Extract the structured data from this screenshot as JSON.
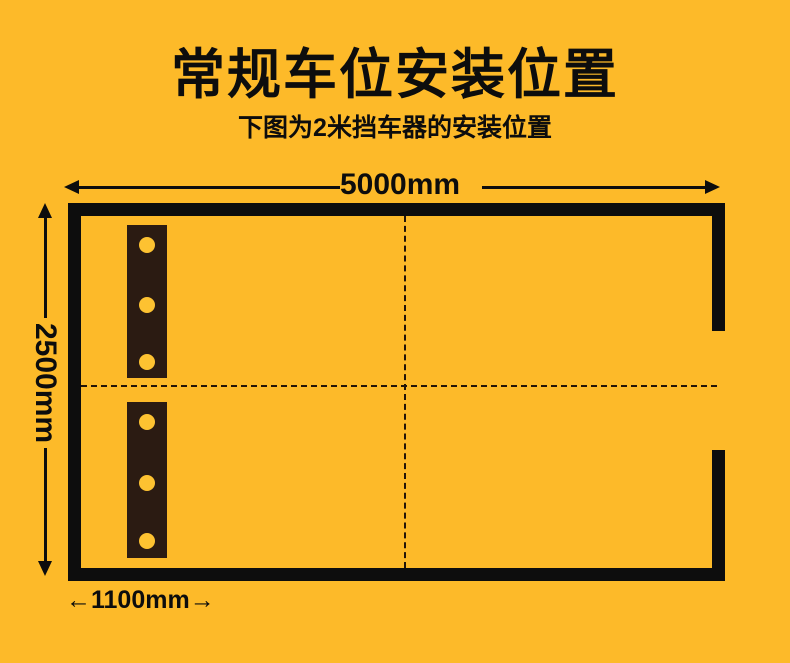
{
  "title": "常规车位安装位置",
  "subtitle": "下图为2米挡车器的安装位置",
  "dimensions": {
    "width": {
      "label": "5000mm"
    },
    "height": {
      "label": "2500mm"
    },
    "offset": {
      "label": "1100mm",
      "arrow_left": "←",
      "arrow_right": "→"
    }
  },
  "diagram": {
    "parking_space": {
      "width_mm": 5000,
      "depth_mm": 2500,
      "entrance_side": "right",
      "entrance_gap": true
    },
    "wheel_stoppers": {
      "count": 2,
      "holes_per_stopper": 3,
      "offset_from_left_mm": 1100,
      "stopper_length_m": 2
    }
  },
  "colors": {
    "background": "#fdba29",
    "ink": "#0d0d0d",
    "stopper": "#2b1b12",
    "hole": "#fdc231",
    "dash": "#221509"
  }
}
